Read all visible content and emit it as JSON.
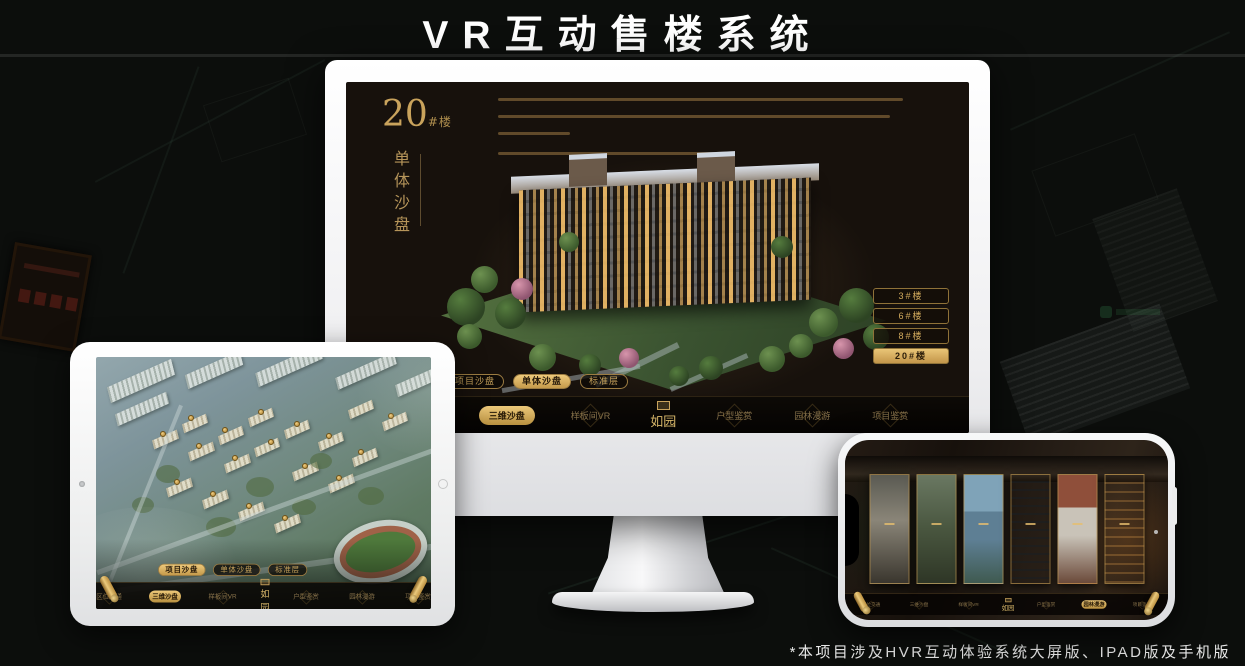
{
  "page": {
    "title": "VR互动售楼系统",
    "footnote": "*本项目涉及HVR互动体验系统大屏版、IPAD版及手机版"
  },
  "colors": {
    "gold": "#c9a35c",
    "gold_bright": "#e6c171",
    "screen_bg": "#17110c",
    "page_bg": "#0c0e0c"
  },
  "monitor": {
    "header": {
      "number": "20",
      "unit": "#楼",
      "vertical_subtitle": "单体沙盘"
    },
    "floor_buttons": [
      {
        "label": "3#楼"
      },
      {
        "label": "6#楼"
      },
      {
        "label": "8#楼"
      },
      {
        "label": "20#楼",
        "active": true
      }
    ],
    "subtabs": [
      {
        "label": "项目沙盘"
      },
      {
        "label": "单体沙盘",
        "active": true
      },
      {
        "label": "标准层"
      }
    ],
    "nav": {
      "logo": "如园",
      "items": [
        {
          "label": "区位交通"
        },
        {
          "label": "三维沙盘",
          "active": true
        },
        {
          "label": "样板间VR"
        },
        {
          "label": "户型鉴赏"
        },
        {
          "label": "园林漫游"
        },
        {
          "label": "项目鉴赏"
        }
      ]
    }
  },
  "tablet": {
    "subtabs": [
      {
        "label": "项目沙盘",
        "active": true
      },
      {
        "label": "单体沙盘"
      },
      {
        "label": "标准层"
      }
    ],
    "nav": {
      "logo": "如园",
      "items": [
        {
          "label": "区位交通"
        },
        {
          "label": "三维沙盘",
          "active": true
        },
        {
          "label": "样板间VR"
        },
        {
          "label": "户型鉴赏"
        },
        {
          "label": "园林漫游"
        },
        {
          "label": "项目鉴赏"
        }
      ]
    }
  },
  "phone": {
    "nav": {
      "logo": "如园",
      "items": [
        {
          "label": "区位交通"
        },
        {
          "label": "三维沙盘"
        },
        {
          "label": "样板间VR"
        },
        {
          "label": "户型鉴赏"
        },
        {
          "label": "园林漫游",
          "active": true
        },
        {
          "label": "项目鉴赏"
        }
      ]
    }
  }
}
